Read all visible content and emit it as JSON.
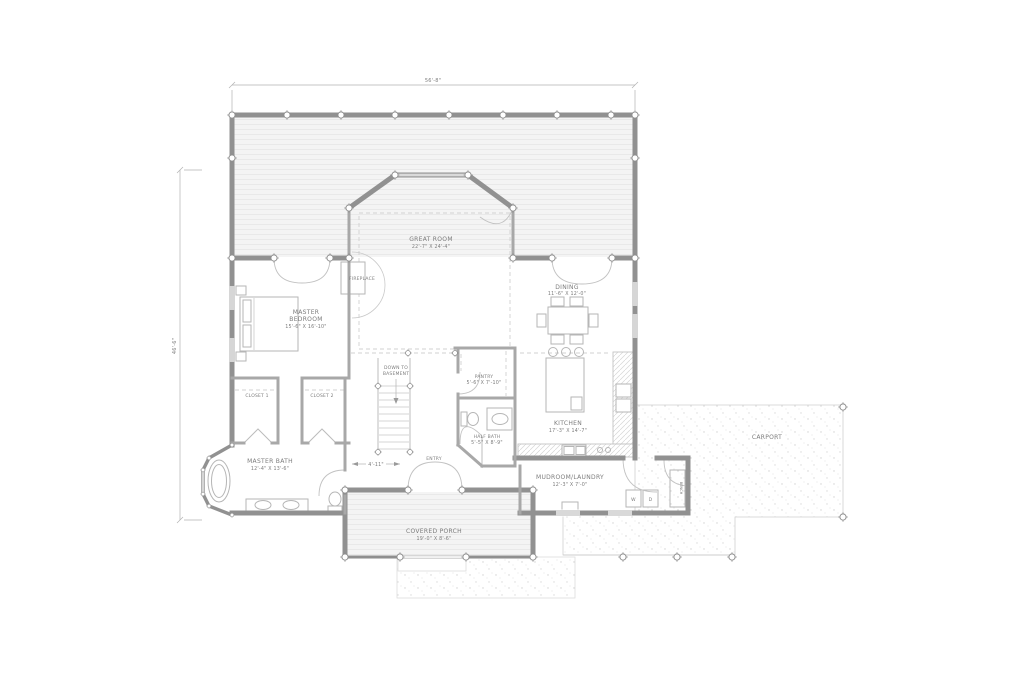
{
  "drawing": {
    "title": "First Floor Plan",
    "colors": {
      "wall": "#919191",
      "interior_wall": "#a8a8a8",
      "text": "#7c7c7c",
      "deck_fill": "#f4f4f4"
    },
    "dimensions": {
      "top": "56'-8\"",
      "left": "46'-6\"",
      "foyer": "4'-11\""
    },
    "rooms": {
      "great_room": {
        "name": "GREAT ROOM",
        "size": "22'-7\" X 24'-4\""
      },
      "fireplace": {
        "name": "FIREPLACE"
      },
      "master_bedroom": {
        "name": "MASTER",
        "name2": "BEDROOM",
        "size": "15'-6\" X 16'-10\""
      },
      "dining": {
        "name": "DINING",
        "size": "11'-6\" X 12'-0\""
      },
      "kitchen": {
        "name": "KITCHEN",
        "size": "17'-3\" X 14'-7\""
      },
      "pantry": {
        "name": "PANTRY",
        "size": "5'-6\" X 7'-10\""
      },
      "half_bath": {
        "name": "HALF BATH",
        "size": "5'-5\" X 8'-9\""
      },
      "stairs": {
        "line1": "DOWN TO",
        "line2": "BASEMENT"
      },
      "closet_1": {
        "name": "CLOSET 1"
      },
      "closet_2": {
        "name": "CLOSET 2"
      },
      "master_bath": {
        "name": "MASTER BATH",
        "size": "12'-4\" X 13'-6\""
      },
      "entry": {
        "name": "ENTRY"
      },
      "mudroom": {
        "name": "MUDROOM/LAUNDRY",
        "size": "12'-3\" X 7'-0\""
      },
      "covered_porch": {
        "name": "COVERED PORCH",
        "size": "19'-0\" X 8'-6\""
      },
      "carport": {
        "name": "CARPORT"
      },
      "bench": {
        "name": "BENCH"
      },
      "washer": "W",
      "dryer": "D"
    }
  }
}
